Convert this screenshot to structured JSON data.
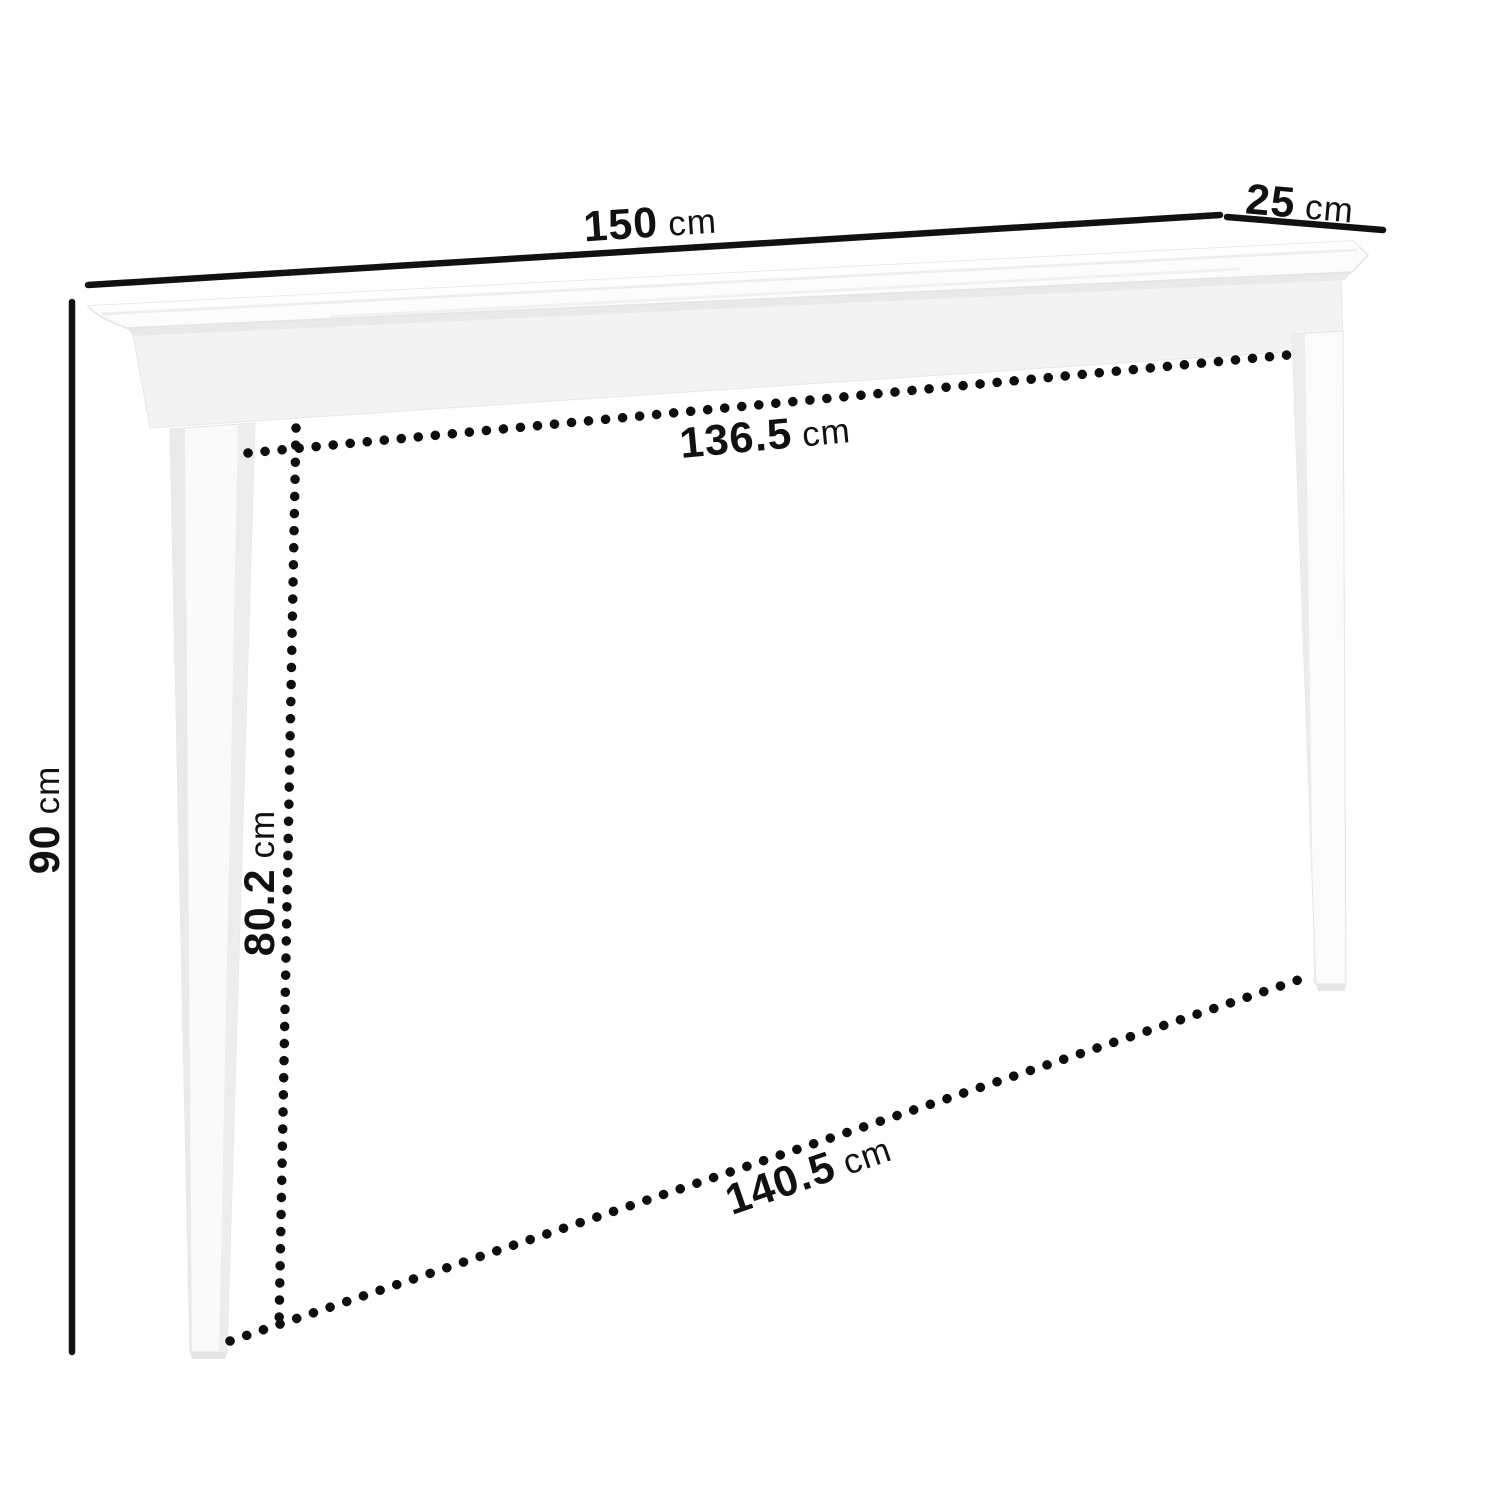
{
  "diagram": {
    "kind": "furniture-dimension-diagram",
    "subject": "console-table",
    "background_color": "#ffffff",
    "line_color": "#111111",
    "table_fill_color": "#fafafa",
    "table_shade_color": "#ededed",
    "dimensions": {
      "width": {
        "value": "150",
        "unit": "cm"
      },
      "depth": {
        "value": "25",
        "unit": "cm"
      },
      "height": {
        "value": "90",
        "unit": "cm"
      },
      "inner_width": {
        "value": "136.5",
        "unit": "cm"
      },
      "inner_height": {
        "value": "80.2",
        "unit": "cm"
      },
      "floor_span": {
        "value": "140.5",
        "unit": "cm"
      }
    }
  }
}
